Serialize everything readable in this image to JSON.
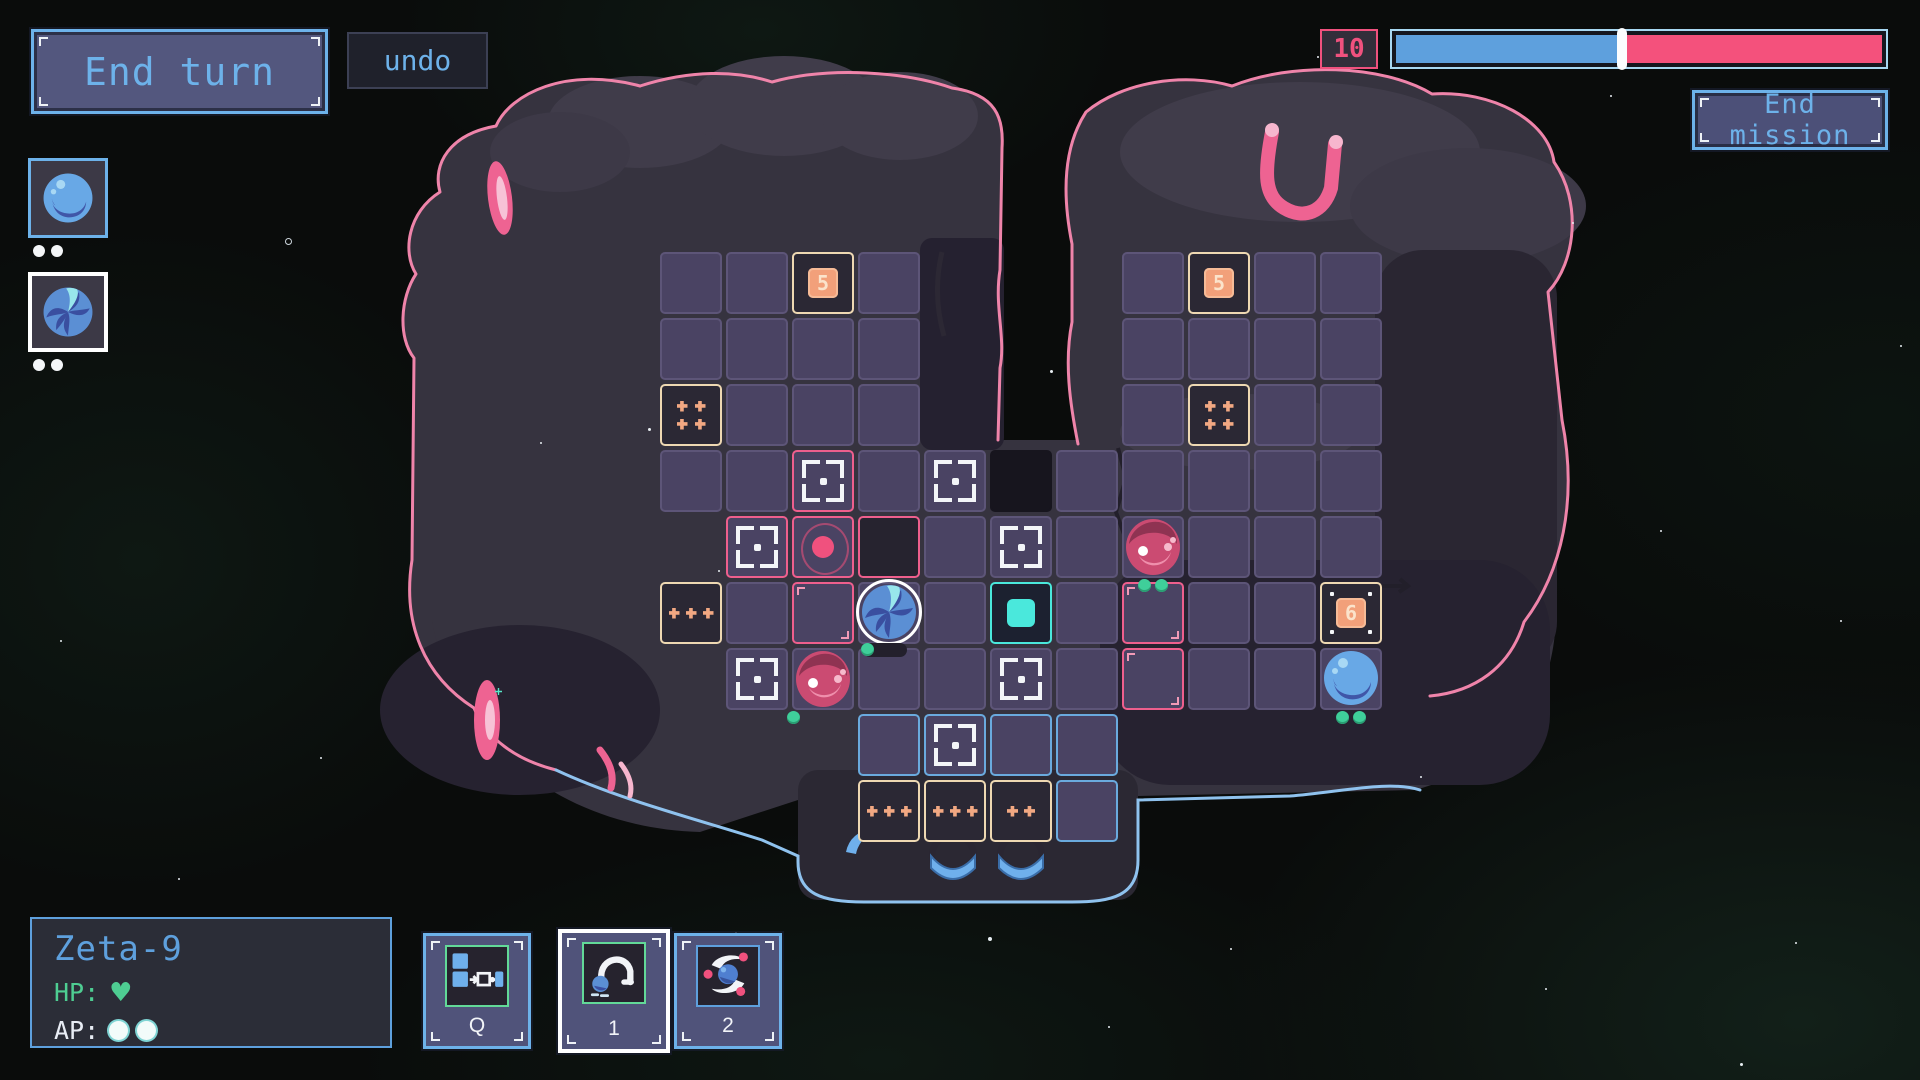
{
  "hud": {
    "end_turn_label": "End turn",
    "undo_label": "undo",
    "turn_counter": "10",
    "mission_bar": {
      "blue_fraction": 0.465
    },
    "end_mission_label": "End mission"
  },
  "roster": {
    "slots": [
      {
        "sprite": "planet-smooth",
        "pips": 2,
        "selected": false
      },
      {
        "sprite": "planet-swirl",
        "pips": 2,
        "selected": true
      }
    ]
  },
  "unit_panel": {
    "name": "Zeta-9",
    "hp_label": "HP:",
    "hp_hearts": 1,
    "ap_label": "AP:",
    "ap_pips": 2
  },
  "abilities": [
    {
      "key": "Q",
      "icon": "push-blocks",
      "selected": false
    },
    {
      "key": "1",
      "icon": "hop-arc",
      "selected": true
    },
    {
      "key": "2",
      "icon": "orbit-swirl",
      "selected": false
    }
  ],
  "board": {
    "geometry": {
      "origin_x": 660,
      "origin_y": 252,
      "pitch": 66,
      "cell": 62
    },
    "cells": [
      [
        0,
        0,
        "plain"
      ],
      [
        1,
        0,
        "plain"
      ],
      [
        2,
        0,
        "num",
        "5"
      ],
      [
        3,
        0,
        "plain"
      ],
      [
        7,
        0,
        "plain"
      ],
      [
        8,
        0,
        "num",
        "5"
      ],
      [
        9,
        0,
        "plain"
      ],
      [
        10,
        0,
        "plain"
      ],
      [
        0,
        1,
        "plain"
      ],
      [
        1,
        1,
        "plain"
      ],
      [
        2,
        1,
        "plain"
      ],
      [
        3,
        1,
        "plain"
      ],
      [
        7,
        1,
        "plain"
      ],
      [
        8,
        1,
        "plain"
      ],
      [
        9,
        1,
        "plain"
      ],
      [
        10,
        1,
        "plain"
      ],
      [
        0,
        2,
        "dots4"
      ],
      [
        1,
        2,
        "plain"
      ],
      [
        2,
        2,
        "plain"
      ],
      [
        3,
        2,
        "plain"
      ],
      [
        7,
        2,
        "plain"
      ],
      [
        8,
        2,
        "dots4"
      ],
      [
        9,
        2,
        "plain"
      ],
      [
        10,
        2,
        "plain"
      ],
      [
        0,
        3,
        "plain"
      ],
      [
        1,
        3,
        "plain"
      ],
      [
        2,
        3,
        "crossPink"
      ],
      [
        3,
        3,
        "plain"
      ],
      [
        4,
        3,
        "cross"
      ],
      [
        5,
        3,
        "hole"
      ],
      [
        6,
        3,
        "plain"
      ],
      [
        7,
        3,
        "plain"
      ],
      [
        8,
        3,
        "plain"
      ],
      [
        9,
        3,
        "plain"
      ],
      [
        10,
        3,
        "plain"
      ],
      [
        1,
        4,
        "crossPink"
      ],
      [
        2,
        4,
        "pinkCircle"
      ],
      [
        3,
        4,
        "darkPink"
      ],
      [
        4,
        4,
        "plain"
      ],
      [
        5,
        4,
        "cross"
      ],
      [
        6,
        4,
        "plain"
      ],
      [
        7,
        4,
        "plain"
      ],
      [
        8,
        4,
        "plain"
      ],
      [
        9,
        4,
        "plain"
      ],
      [
        10,
        4,
        "plain"
      ],
      [
        0,
        5,
        "dots3"
      ],
      [
        1,
        5,
        "plain"
      ],
      [
        2,
        5,
        "pinkEmpty"
      ],
      [
        3,
        5,
        "plain"
      ],
      [
        4,
        5,
        "plain"
      ],
      [
        5,
        5,
        "cyanSquare"
      ],
      [
        6,
        5,
        "plain"
      ],
      [
        7,
        5,
        "pinkEmpty"
      ],
      [
        8,
        5,
        "plain"
      ],
      [
        9,
        5,
        "plain"
      ],
      [
        10,
        5,
        "num6",
        "6"
      ],
      [
        1,
        6,
        "cross"
      ],
      [
        2,
        6,
        "plain"
      ],
      [
        3,
        6,
        "plain"
      ],
      [
        4,
        6,
        "plain"
      ],
      [
        5,
        6,
        "cross"
      ],
      [
        6,
        6,
        "plain"
      ],
      [
        7,
        6,
        "pinkEmpty"
      ],
      [
        8,
        6,
        "plain"
      ],
      [
        9,
        6,
        "plain"
      ],
      [
        10,
        6,
        "plain"
      ],
      [
        3,
        7,
        "blueCell"
      ],
      [
        4,
        7,
        "blueCross"
      ],
      [
        5,
        7,
        "blueCell"
      ],
      [
        6,
        7,
        "blueCell"
      ],
      [
        3,
        8,
        "dots3"
      ],
      [
        4,
        8,
        "dots3"
      ],
      [
        5,
        8,
        "dots2"
      ],
      [
        6,
        8,
        "blueCell"
      ]
    ],
    "units": [
      {
        "id": "zeta9",
        "sprite": "planet-swirl",
        "col": 3,
        "row": 5,
        "selected": true,
        "hp_pill": true,
        "green_dots": 0
      },
      {
        "id": "enemy-pink-a",
        "sprite": "orb-pink",
        "col": 2,
        "row": 6,
        "green_dots": 1,
        "dots_align": "left"
      },
      {
        "id": "enemy-pink-b",
        "sprite": "orb-pink",
        "col": 7,
        "row": 4,
        "green_dots": 2,
        "dots_align": "center"
      },
      {
        "id": "ally-blue",
        "sprite": "planet-smooth",
        "col": 10,
        "row": 6,
        "green_dots": 2,
        "dots_align": "center"
      }
    ]
  },
  "colors": {
    "accent_blue": "#6db2ea",
    "accent_pink": "#f0517e",
    "bar_blue": "#5ea0dd",
    "bar_pink": "#f4517c",
    "hp_green": "#4ecd92",
    "dot_green": "#3fcf9a",
    "tile_cream": "#eed8b2",
    "tile_orange": "#f2a07a",
    "cyan": "#4ae8dc",
    "rim_pink": "#ef84aa",
    "rim_blue": "#8fc2ee"
  }
}
